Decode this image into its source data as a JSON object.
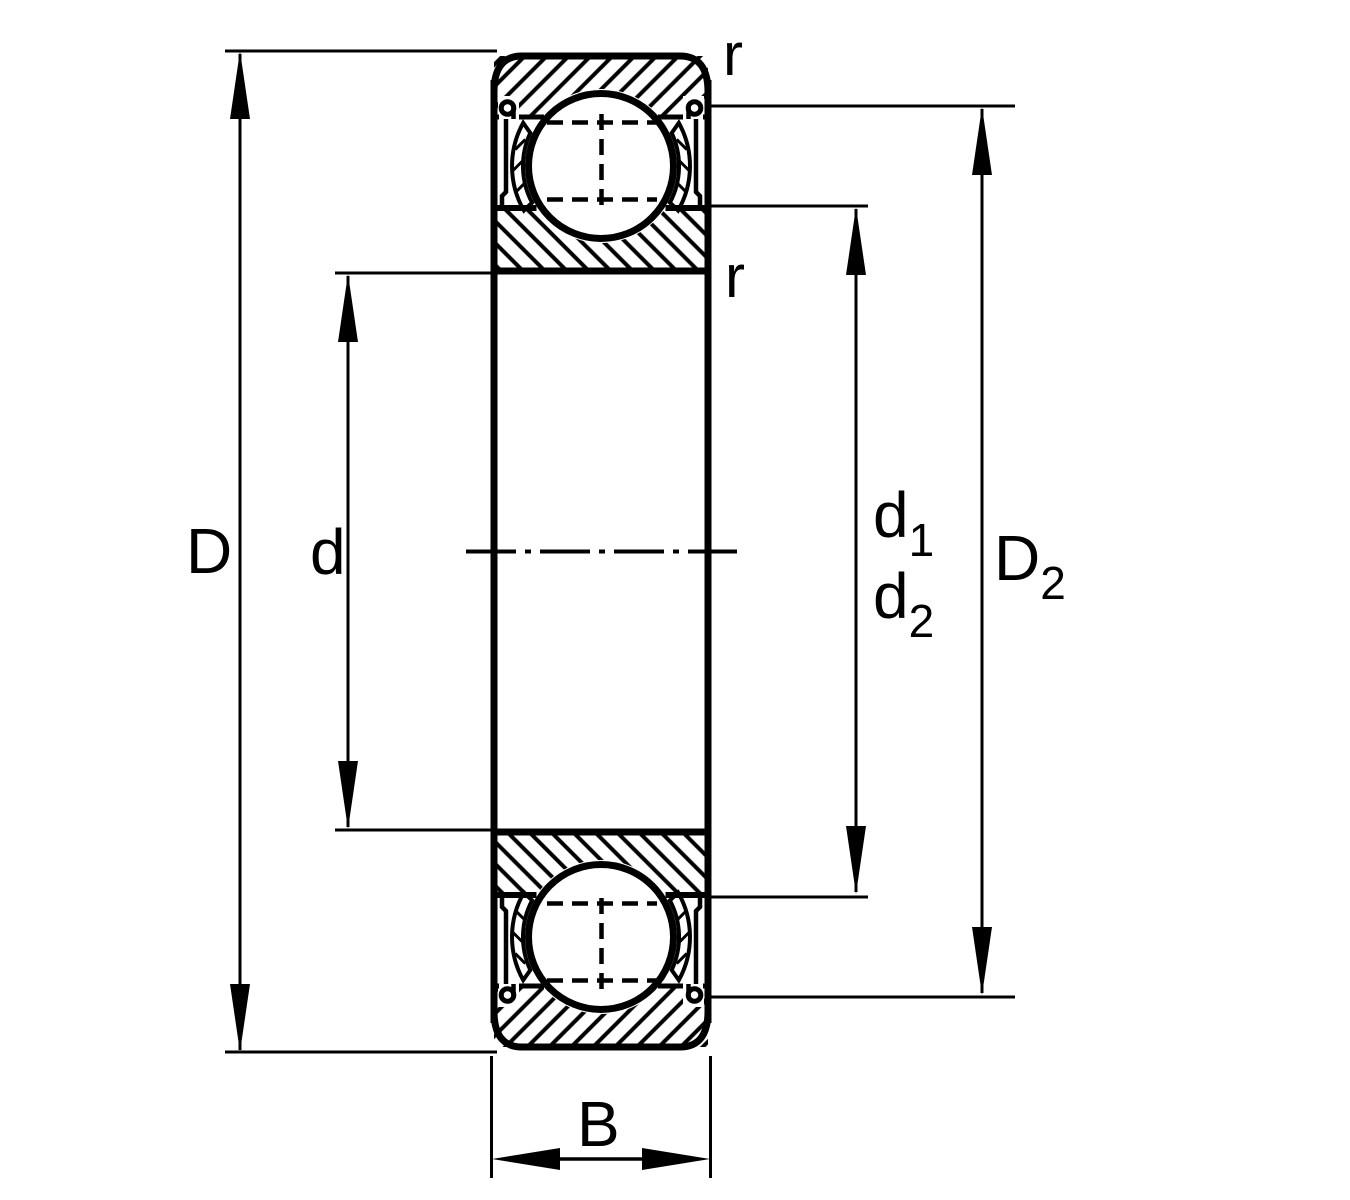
{
  "diagram": {
    "background_color": "#ffffff",
    "line_color": "#000000",
    "labels": {
      "outside_diameter": "D",
      "bore_diameter": "d",
      "d1": {
        "base": "d",
        "sub": "1"
      },
      "d2": {
        "base": "d",
        "sub": "2"
      },
      "D2": {
        "base": "D",
        "sub": "2"
      },
      "width": "B",
      "corner_radius_outer": "r",
      "corner_radius_inner": "r"
    }
  }
}
